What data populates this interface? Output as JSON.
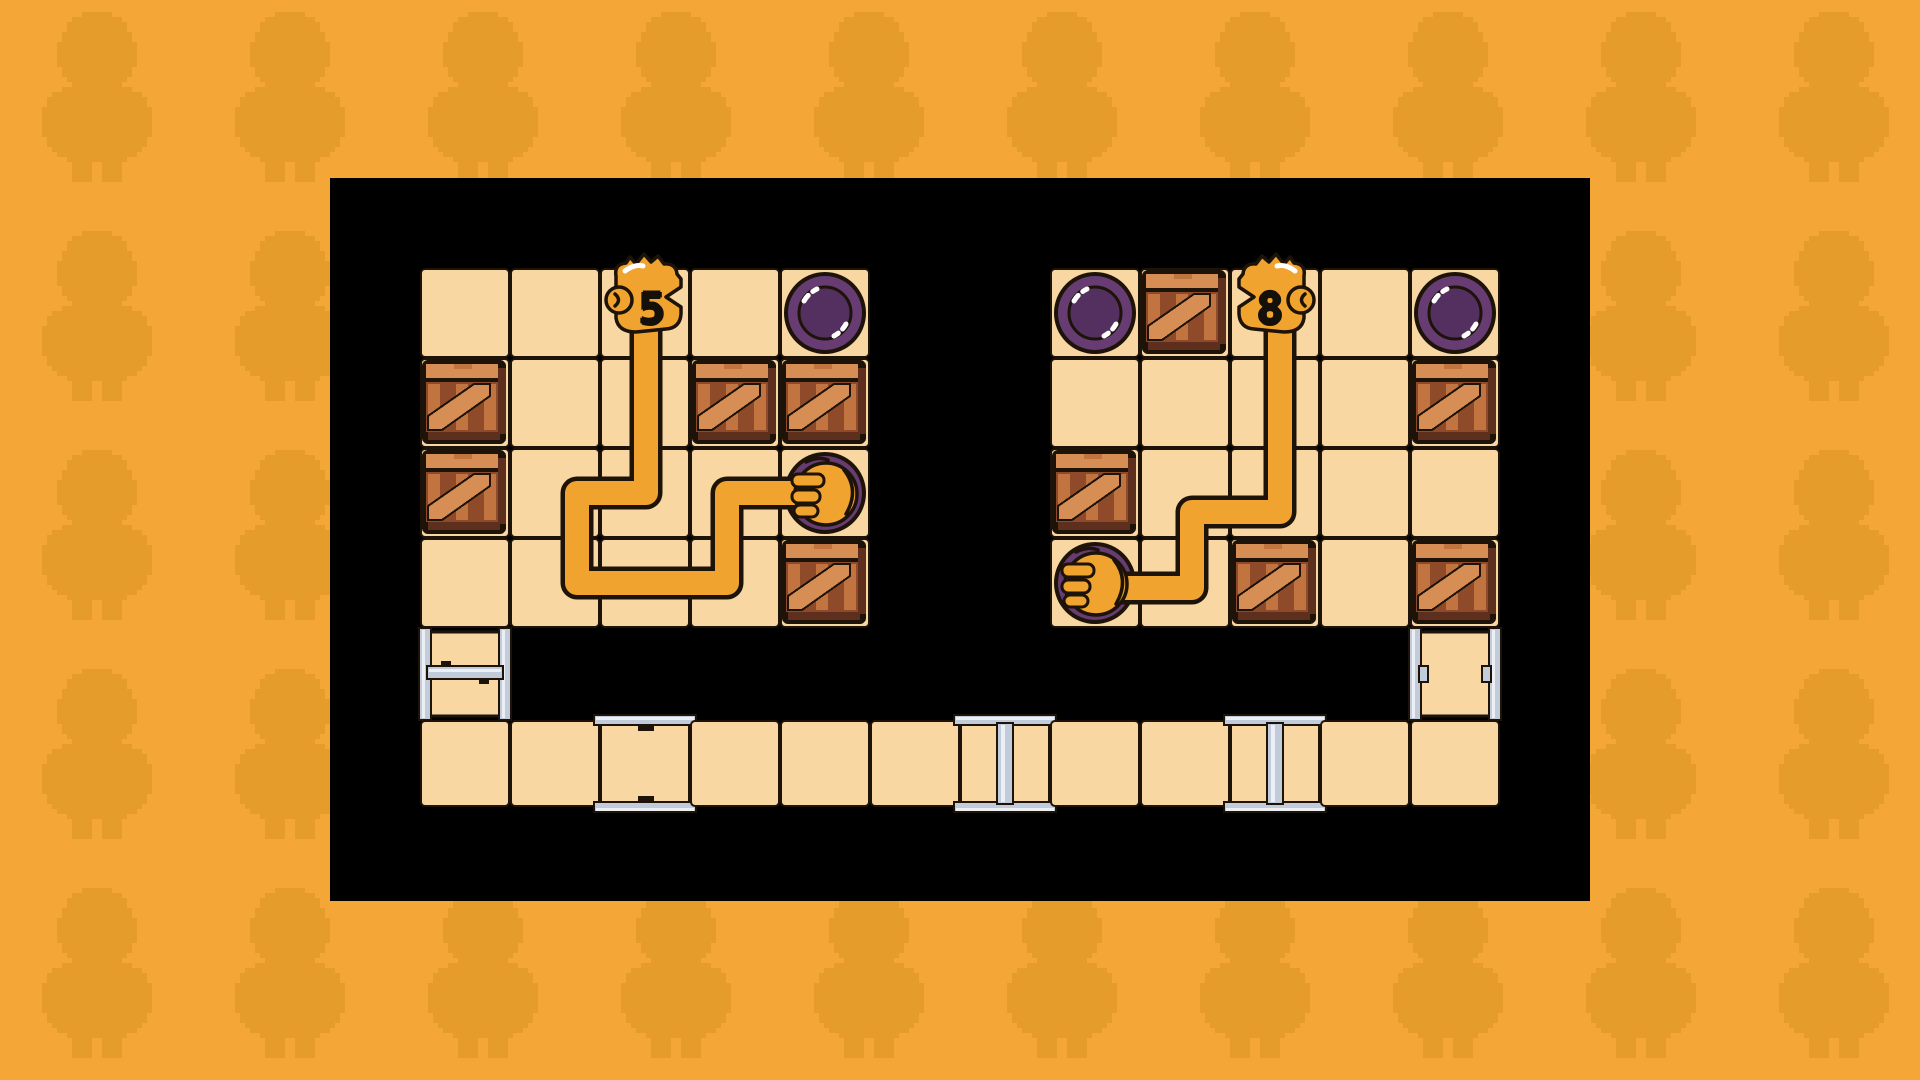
{
  "colors": {
    "background": "#F4A637",
    "background_pattern": "#E69C2B",
    "board": "#000000",
    "tile": "#F8D7A2",
    "outline": "#1D1308",
    "arm": "#F0A42F",
    "highlight": "#FFFFFF",
    "disc_ring": "#663C72",
    "disc_face": "#533060",
    "crate_light": "#D68E55",
    "crate_base": "#C1743F",
    "crate_dark": "#8F4A2A",
    "crate_deep": "#5F2F1E",
    "silver": "#C2CBD9",
    "silver_light": "#ECF0F5"
  },
  "board": {
    "x": 330,
    "y": 178,
    "width": 1260,
    "height": 723
  },
  "grids": [
    {
      "id": "left",
      "x": 420,
      "y": 268,
      "cols": 5,
      "rows": 4,
      "tile_size": 90
    },
    {
      "id": "right",
      "x": 1050,
      "y": 268,
      "cols": 5,
      "rows": 4,
      "tile_size": 90
    }
  ],
  "heads": [
    {
      "grid": "left",
      "col": 3,
      "row": 1,
      "label": "5",
      "facing": "right"
    },
    {
      "grid": "right",
      "col": 3,
      "row": 1,
      "label": "8",
      "facing": "left"
    }
  ],
  "hands": [
    {
      "grid": "left",
      "col": 5,
      "row": 3
    },
    {
      "grid": "right",
      "col": 1,
      "row": 4
    }
  ],
  "buttons": [
    {
      "grid": "left",
      "col": 5,
      "row": 1,
      "pressed": false
    },
    {
      "grid": "left",
      "col": 5,
      "row": 3,
      "pressed": true
    },
    {
      "grid": "right",
      "col": 1,
      "row": 1,
      "pressed": false
    },
    {
      "grid": "right",
      "col": 5,
      "row": 1,
      "pressed": false
    },
    {
      "grid": "right",
      "col": 1,
      "row": 4,
      "pressed": true
    }
  ],
  "crates": [
    {
      "grid": "left",
      "col": 1,
      "row": 2
    },
    {
      "grid": "left",
      "col": 4,
      "row": 2
    },
    {
      "grid": "left",
      "col": 5,
      "row": 2
    },
    {
      "grid": "left",
      "col": 1,
      "row": 3
    },
    {
      "grid": "left",
      "col": 5,
      "row": 4
    },
    {
      "grid": "right",
      "col": 2,
      "row": 1
    },
    {
      "grid": "right",
      "col": 5,
      "row": 2
    },
    {
      "grid": "right",
      "col": 1,
      "row": 3
    },
    {
      "grid": "right",
      "col": 3,
      "row": 4
    },
    {
      "grid": "right",
      "col": 5,
      "row": 4
    }
  ],
  "arms": [
    {
      "id": "left-arm",
      "points": [
        [
          646,
          330
        ],
        [
          646,
          493
        ],
        [
          577,
          493
        ],
        [
          577,
          583
        ],
        [
          727,
          583
        ],
        [
          727,
          493
        ],
        [
          812,
          493
        ]
      ]
    },
    {
      "id": "right-arm",
      "points": [
        [
          1280,
          330
        ],
        [
          1280,
          512
        ],
        [
          1192,
          512
        ],
        [
          1192,
          588
        ],
        [
          1098,
          588
        ]
      ]
    }
  ],
  "side_tiles": [
    {
      "type": "ladder",
      "side": "left",
      "x": 420,
      "y": 630,
      "width": 90,
      "height": 88
    },
    {
      "type": "ladder",
      "side": "right",
      "x": 1410,
      "y": 630,
      "width": 90,
      "height": 88
    }
  ],
  "bottom_row": {
    "x": 420,
    "y": 720,
    "tile_size": 90,
    "count": 12,
    "height": 87,
    "clamp_indices": [
      2
    ],
    "ibeam_indices": [
      6,
      9
    ]
  },
  "pattern": {
    "start_x": -156,
    "start_y": 12,
    "pitch_x": 193,
    "pitch_y": 219,
    "cols": 11,
    "rows": 5,
    "chick_width": 120,
    "chick_height": 170
  }
}
